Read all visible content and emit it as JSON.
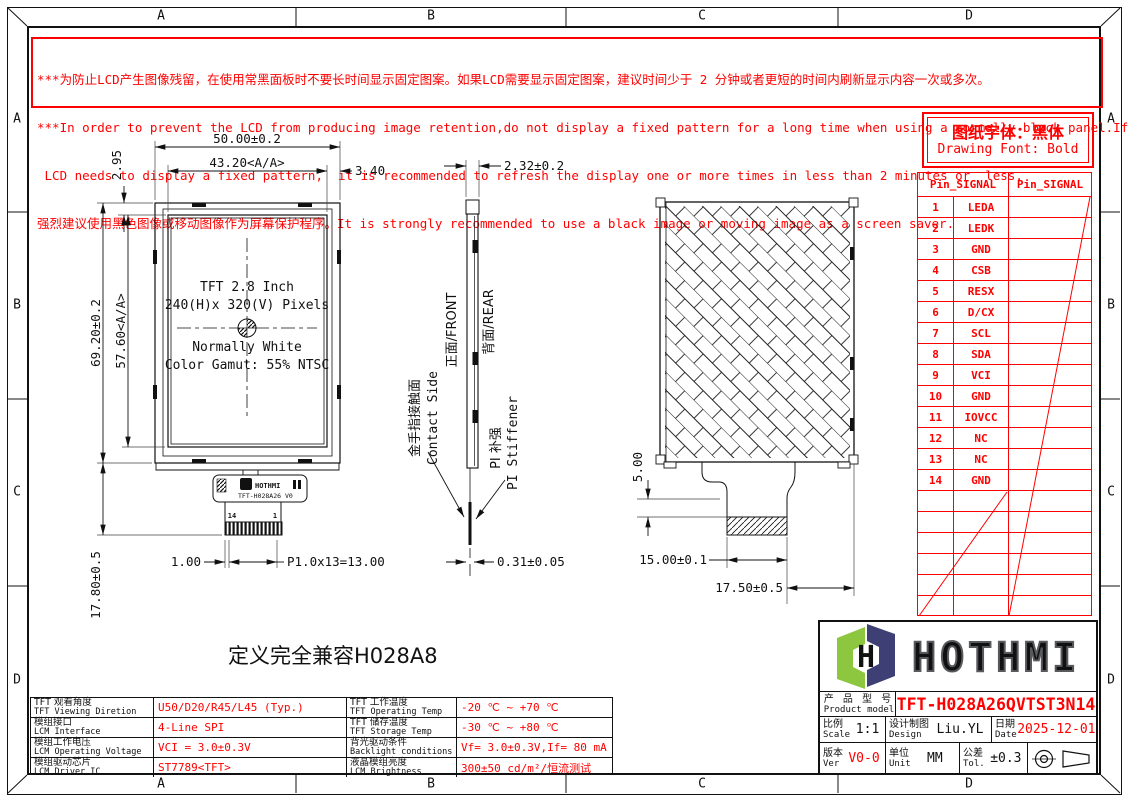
{
  "border": {
    "cols": [
      "A",
      "B",
      "C",
      "D"
    ],
    "rows": [
      "A",
      "B",
      "C",
      "D"
    ]
  },
  "warning": {
    "line1": "***为防止LCD产生图像残留，在使用常黑面板时不要长时间显示固定图案。如果LCD需要显示固定图案，建议时间少于 2 分钟或者更短的时间内刷新显示内容一次或多次。",
    "line2": "***In order to prevent the LCD from producing image retention,do not display a fixed pattern for a long time when using a normally black panel.If the",
    "line3": " LCD needs to display a fixed pattern,  it is recommended to refresh the display one or more times in less than 2 minutes or  less.",
    "line4": "强烈建议使用黑色图像或移动图像作为屏幕保护程序。It is strongly recommended to use a black image or moving image as a screen saver."
  },
  "font_note": {
    "cn": "图纸字体：黑体",
    "en": "Drawing Font: Bold"
  },
  "pin_table": {
    "header_left": "Pin_SIGNAL",
    "header_right": "Pin_SIGNAL",
    "pins": [
      {
        "no": "1",
        "signal": "LEDA"
      },
      {
        "no": "2",
        "signal": "LEDK"
      },
      {
        "no": "3",
        "signal": "GND"
      },
      {
        "no": "4",
        "signal": "CSB"
      },
      {
        "no": "5",
        "signal": "RESX"
      },
      {
        "no": "6",
        "signal": "D/CX"
      },
      {
        "no": "7",
        "signal": "SCL"
      },
      {
        "no": "8",
        "signal": "SDA"
      },
      {
        "no": "9",
        "signal": "VCI"
      },
      {
        "no": "10",
        "signal": "GND"
      },
      {
        "no": "11",
        "signal": "IOVCC"
      },
      {
        "no": "12",
        "signal": "NC"
      },
      {
        "no": "13",
        "signal": "NC"
      },
      {
        "no": "14",
        "signal": "GND"
      }
    ]
  },
  "views": {
    "front": {
      "labels": {
        "l1": "TFT 2.8 Inch",
        "l2": "240(H)x 320(V) Pixels",
        "l3": "Normally White",
        "l4": "Color Gamut: 55% NTSC"
      },
      "dims": {
        "width": "50.00±0.2",
        "active_width": "43.20<A/A>",
        "top": "2.95",
        "right": "3.40",
        "height": "69.20±0.2",
        "active_height": "57.60<A/A>",
        "tail": "17.80±0.5",
        "offset": "1.00",
        "pitch": "P1.0x13=13.00"
      },
      "fpc": {
        "brand": "HOTHMI",
        "model": "TFT-H028A26 V0",
        "pin14": "14",
        "pin1": "1"
      }
    },
    "side": {
      "dims": {
        "thickness": "2.32±0.2",
        "fpc": "0.31±0.05"
      },
      "front_label": "正面/FRONT",
      "rear_label": "背面/REAR",
      "contact_cn": "金手指接触面",
      "contact_en": "Contact Side",
      "stiffener_cn": "PI 补强",
      "stiffener_en": "PI Stiffener"
    },
    "rear": {
      "dims": {
        "drop": "5.00",
        "stiffener": "15.00±0.1",
        "tail": "17.50±0.5"
      }
    }
  },
  "compat_note": "定义完全兼容H028A8",
  "spec_table": {
    "rows": [
      {
        "c1_cn": "TFT 观看角度",
        "c1_en": "TFT Viewing Diretion",
        "v1": "U50/D20/R45/L45 (Typ.)",
        "c2_cn": "TFT 工作温度",
        "c2_en": "TFT Operating Temp",
        "v2": "-20 ℃ ~ +70 ℃"
      },
      {
        "c1_cn": "模组接口",
        "c1_en": "LCM Interface",
        "v1": "4-Line SPI",
        "c2_cn": "TFT 储存温度",
        "c2_en": "TFT Storage Temp",
        "v2": "-30 ℃ ~ +80 ℃"
      },
      {
        "c1_cn": "模组工作电压",
        "c1_en": "LCM Operating Voltage",
        "v1": "VCI = 3.0±0.3V",
        "c2_cn": "背光驱动条件",
        "c2_en": "Backlight conditions",
        "v2": "Vf= 3.0±0.3V,If= 80 mA"
      },
      {
        "c1_cn": "模组驱动芯片",
        "c1_en": "LCM Driver IC",
        "v1": "ST7789<TFT>",
        "c2_cn": "液晶模组亮度",
        "c2_en": "LCM Brightness",
        "v2": "300±50  cd/m²/恒流测试"
      }
    ]
  },
  "title_block": {
    "brand": "HOTHMI",
    "logo_h": "H",
    "product_label_cn": "产 品 型 号",
    "product_label_en": "Product model",
    "product_model": "TFT-H028A26QVTST3N14",
    "scale_cn": "比例",
    "scale_en": "Scale",
    "scale": "1:1",
    "design_cn": "设计制图",
    "design_en": "Design",
    "designer": "Liu.YL",
    "date_cn": "日期",
    "date_en": "Date",
    "date": "2025-12-01",
    "ver_cn": "版本",
    "ver_en": "Ver",
    "version": "V0-0",
    "unit_cn": "单位",
    "unit_en": "Unit",
    "unit": "MM",
    "tol_cn": "公差",
    "tol_en": "Tol.",
    "tolerance": "±0.3"
  },
  "colors": {
    "accent_red": "#ff0000",
    "line_black": "#111111",
    "logo_green": "#8dc63f",
    "logo_navy": "#3d3f75",
    "logo_gray": "#595a5e"
  }
}
